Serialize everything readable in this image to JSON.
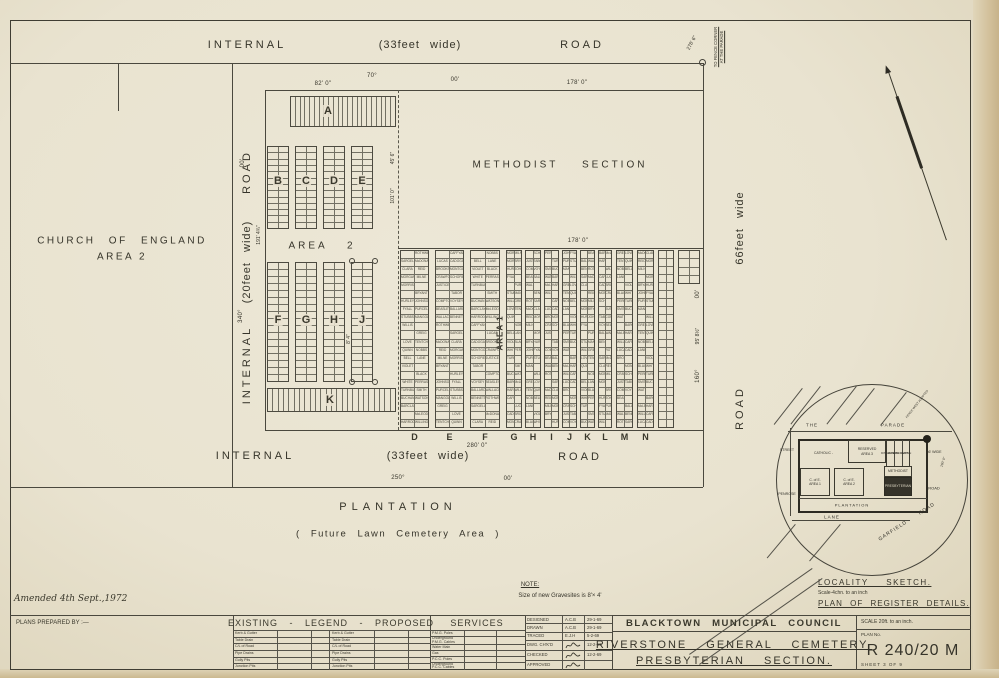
{
  "roads": {
    "top": {
      "name": "INTERNAL",
      "width": "(33feet wide)",
      "road": "ROAD"
    },
    "bottom": {
      "name": "INTERNAL",
      "width": "(33feet wide)",
      "road": "ROAD"
    },
    "left": {
      "name": "INTERNAL",
      "width": "(20feet wide)",
      "road": "ROAD"
    },
    "right": {
      "width": "66feet wide",
      "road": "ROAD"
    }
  },
  "areas": {
    "church_line1": "CHURCH OF ENGLAND",
    "church_line2": "AREA 2",
    "methodist": "METHODIST SECTION",
    "area2": "AREA 2",
    "area1": "AREA 1",
    "plantation": "PLANTATION",
    "plantation_sub": "( Future Lawn Cemetery Area )"
  },
  "sections": {
    "strip_a": "A",
    "row1": [
      "B",
      "C",
      "D",
      "E"
    ],
    "row2": [
      "F",
      "G",
      "H",
      "J"
    ],
    "strip_k": "K",
    "register_columns": [
      "D",
      "E",
      "F",
      "G",
      "H",
      "I",
      "J",
      "K",
      "L",
      "M",
      "N"
    ]
  },
  "measurements": {
    "top_a": "82' 0\"",
    "top_bearing_deg": "70°",
    "top_bearing_min": "00'",
    "methodist_top": "178' 0\"",
    "register_top": "178' 0\"",
    "register_bottom": "280' 0\"",
    "bottom_bearing_deg": "250°",
    "bottom_bearing_min": "00'",
    "left_len": "191' 4¾\"",
    "left_bearing_deg": "340°",
    "left_bearing_min": "00'",
    "right_len": "95' 8½\"",
    "right_bearing_deg": "160°",
    "right_bearing_min": "00'",
    "inner1": "45' 6\"",
    "inner2": "101' 0\"",
    "inner3": "8' 4\"",
    "corner_tie": "278' 6\"",
    "corner_note1": "TO FENCE CORNER",
    "corner_note2": "AT THE PARADE"
  },
  "note": {
    "title": "NOTE:",
    "body": "Size of new Gravesites is 8'× 4'"
  },
  "locality": {
    "title": "LOCALITY SKETCH.",
    "scale": "Scale-4chn. to an inch",
    "register": "PLAN OF REGISTER DETAILS.",
    "streets": {
      "the": "THE",
      "parade": "PARADE",
      "street": "STREET",
      "penrose": "PENROSE",
      "lane": "LANE",
      "garfield": "GARFIELD",
      "garfield_road": "ROAD",
      "road": "ROAD",
      "road_width": "66' WIDE",
      "len": "160' 0\"",
      "fence": "FENCE WEST ADOPTED"
    },
    "cells": {
      "catholic": "CATHOLIC -",
      "reserved1": "RESERVED",
      "reserved2": "AREA 3",
      "dissenters": "DISSENTERS",
      "independent": "INDEPENDENT",
      "jewish": "JEWISH",
      "methodist": "METHODIST",
      "presbyterian": "PRESBYTERIAN",
      "coe1a": "C. of E.",
      "coe1b": "AREA 1",
      "coe2a": "C. of E.",
      "coe2b": "AREA 2",
      "plantation": "PLANTATION"
    }
  },
  "title_block": {
    "amended": "Amended 4th Sept.,1972",
    "prepared_by": "PLANS PREPARED BY :—",
    "legend_header": "EXISTING - LEGEND - PROPOSED",
    "services_header": "SERVICES",
    "legend_rows": [
      "Kerb & Gutter",
      "Table Drain",
      "C/L of Road",
      "Pipe Drains",
      "Gully Pits",
      "Junction Pits"
    ],
    "services_rows": [
      "P.M.G. Poles",
      "Underground P.M.G. Cables",
      "Water Main",
      "Gas",
      "P.C.C. Poles",
      "Underground P.C.C. Cables"
    ],
    "approvals": [
      {
        "label": "DESIGNED",
        "by": "A.C.B",
        "date": "29-1-69"
      },
      {
        "label": "DRAWN",
        "by": "A.C.B",
        "date": "29-1-69"
      },
      {
        "label": "TRACED",
        "by": "E.J.H",
        "date": "5-2-69"
      },
      {
        "label": "DWG. CH'K'D",
        "by": null,
        "date": "12-2-69"
      },
      {
        "label": "CHECKED",
        "by": null,
        "date": "12-2-69"
      },
      {
        "label": "APPROVED",
        "by": null,
        "date": ""
      }
    ],
    "council": [
      "BLACKTOWN",
      "MUNICIPAL",
      "COUNCIL"
    ],
    "project": "RIVERSTONE GENERAL CEMETERY.",
    "section": "PRESBYTERIAN SECTION.",
    "scale": "SCALE 20ft. to an inch.",
    "plan_no_label": "PLAN No.",
    "plan_no": "R 240/20 M",
    "sheet": "SHEET 3 OF 9"
  },
  "register_names": [
    "ROTHWELL",
    "SARGELL",
    "McDONALD",
    "CLARA",
    "REID",
    "MORGAN",
    "MILNE",
    "MORRIS",
    "BRYANT",
    "HURLEY",
    "JOHNSON",
    "FYALL",
    "PURCELL",
    "STUBBS",
    "MANGOLD",
    "WILLIS",
    "GREIG",
    "LOVE",
    "TENTCH",
    "QUINN",
    "NOBBS",
    "BELL",
    "LANE",
    "VIOLET",
    "BLACK",
    "WHITE",
    "PERRAS",
    "TURNBULL",
    "SMITH",
    "BUCHAN",
    "WATSON",
    "BARCLAY",
    "McLEOD",
    "HARROD",
    "WILLING",
    "CAFFYAN",
    "LUCAS",
    "CADOGAN",
    "BROOKS",
    "MONTGOMERY",
    "CRAWFORD",
    "SCHOFIELD",
    "JUSTICE",
    "TABOR",
    "COMPTON",
    "VOYSEY",
    "BEASLEY",
    "BALLARD",
    "WALLACE",
    "BENNETT"
  ]
}
